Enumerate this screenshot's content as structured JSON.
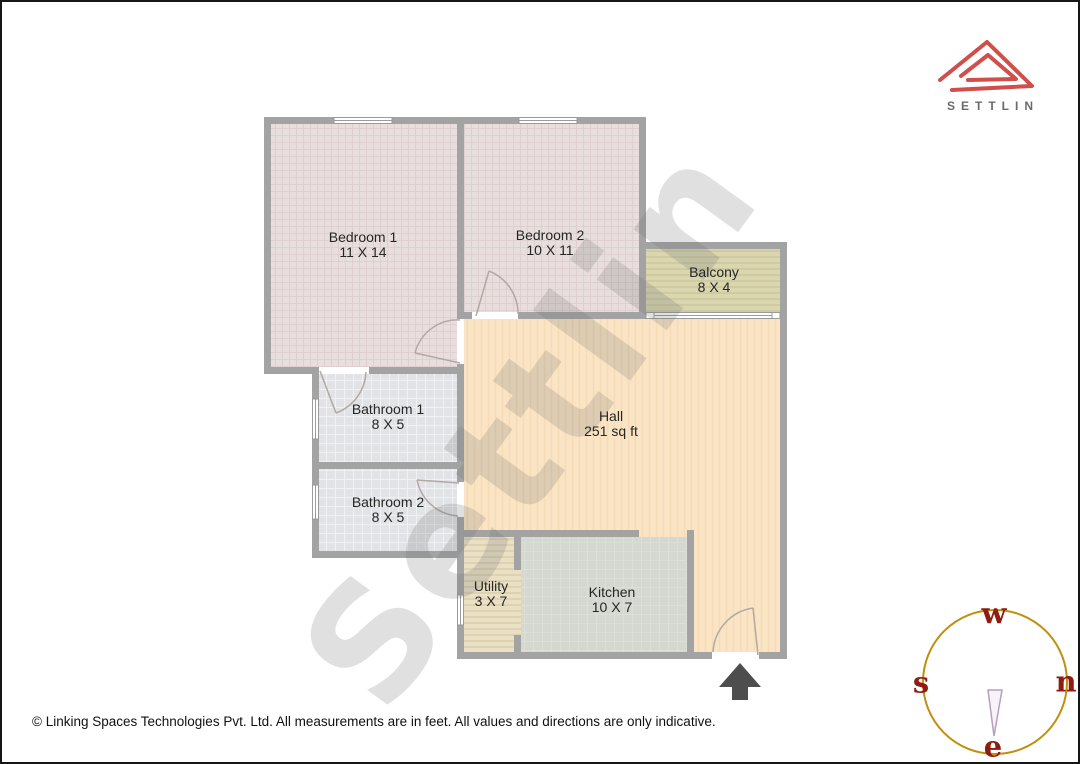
{
  "brand": {
    "name": "SETTLIN",
    "logo_red": "#cf4f4a",
    "text_gray": "#6b6b6b"
  },
  "watermark": {
    "text": "Settlin"
  },
  "rooms": {
    "bedroom1": {
      "name": "Bedroom 1",
      "dims": "11 X 14"
    },
    "bedroom2": {
      "name": "Bedroom 2",
      "dims": "10 X 11"
    },
    "balcony": {
      "name": "Balcony",
      "dims": "8 X 4"
    },
    "bathroom1": {
      "name": "Bathroom 1",
      "dims": "8 X 5"
    },
    "bathroom2": {
      "name": "Bathroom 2",
      "dims": "8 X 5"
    },
    "hall": {
      "name": "Hall",
      "dims": "251 sq ft"
    },
    "utility": {
      "name": "Utility",
      "dims": "3 X 7"
    },
    "kitchen": {
      "name": "Kitchen",
      "dims": "10 X 7"
    }
  },
  "compass": {
    "top": "w",
    "left": "s",
    "right": "n",
    "bottom": "e",
    "circle_color": "#bf8f10",
    "letter_color": "#8f1b12",
    "needle_color": "#b79fc0"
  },
  "palette": {
    "wall": "#a3a3a3",
    "bedroom_fill": "#e9dede",
    "bathroom_fill": "#e2e3e6",
    "hall_fill": "#fbe4c4",
    "balcony_fill": "#d9d6b0",
    "utility_fill": "#eae1c5",
    "kitchen_fill": "#d5d8d0",
    "entrance_arrow": "#4e4e4e"
  },
  "footer": {
    "copyright": "© Linking Spaces Technologies Pvt. Ltd. All measurements are in feet. All values and directions are only indicative."
  }
}
